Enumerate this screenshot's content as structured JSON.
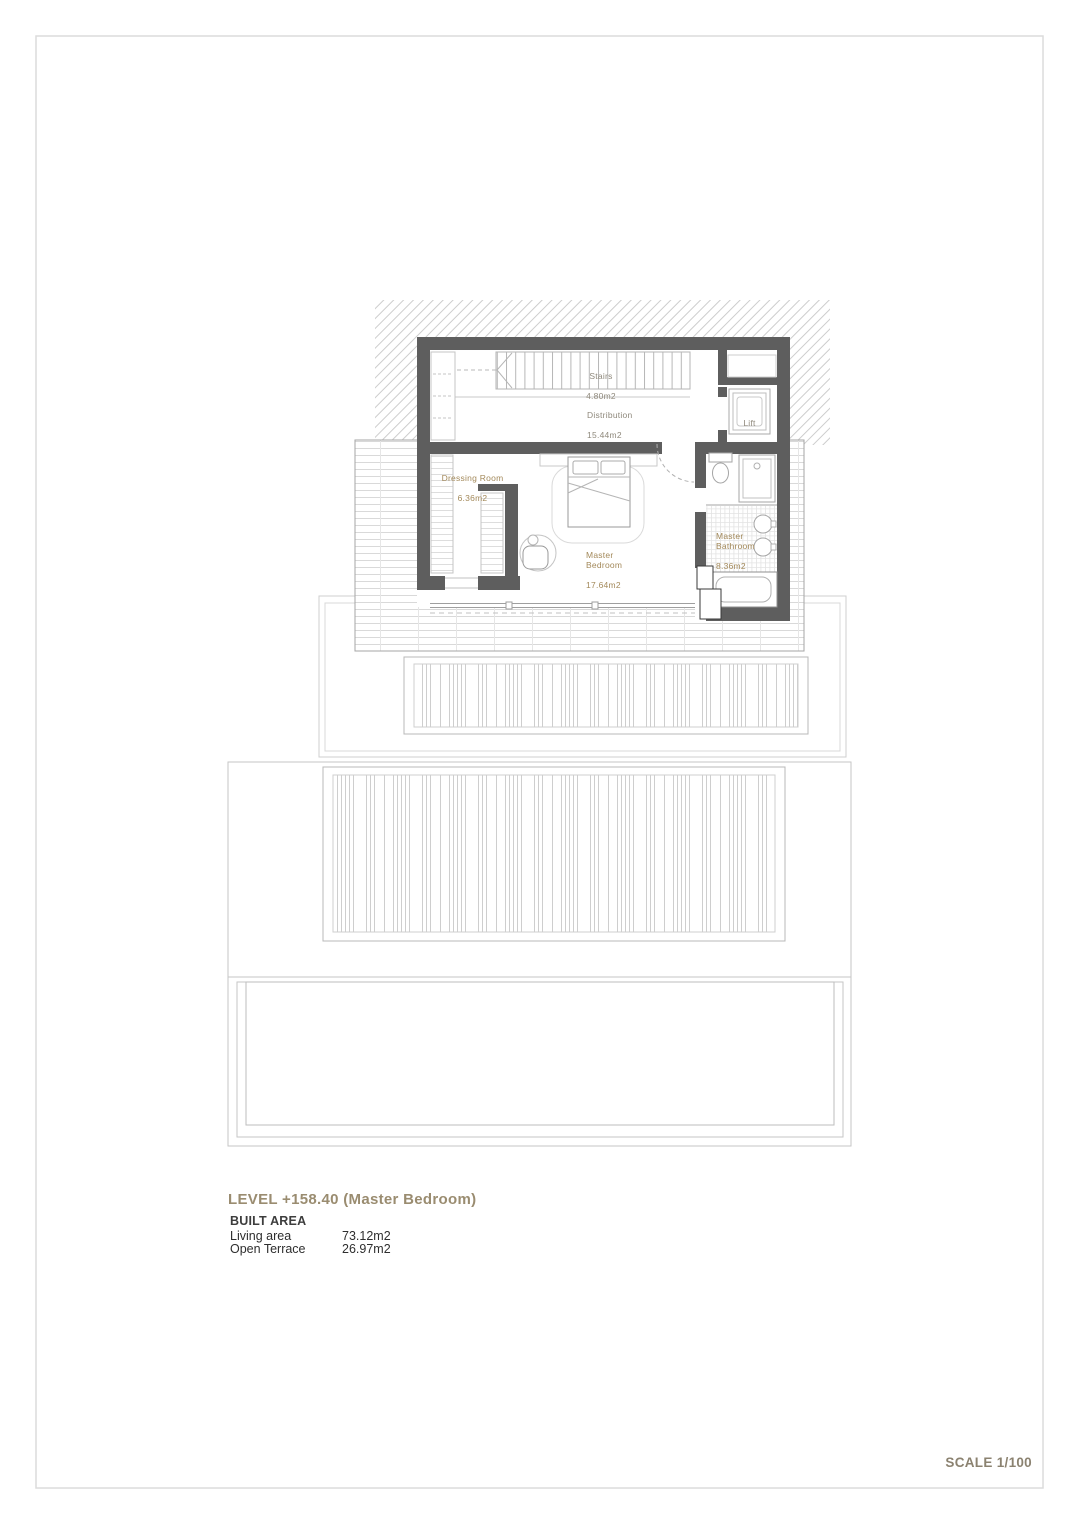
{
  "page": {
    "scale_label": "SCALE 1/100"
  },
  "title_block": {
    "level_title": "LEVEL +158.40 (Master Bedroom)",
    "built_area_heading": "BUILT AREA",
    "areas": [
      {
        "label": "Living area",
        "value": "73.12m2"
      },
      {
        "label": "Open Terrace",
        "value": "26.97m2"
      }
    ]
  },
  "plan": {
    "rooms": [
      {
        "name": "Stairs",
        "area": "4.80m2"
      },
      {
        "name": "Distribution",
        "area": "15.44m2"
      },
      {
        "name": "Lift",
        "area": ""
      },
      {
        "name": "Dressing Room",
        "area": "6.36m2"
      },
      {
        "name": "Master Bedroom",
        "area": "17.64m2"
      },
      {
        "name": "Master Bathroom",
        "area": "8.36m2"
      }
    ]
  },
  "colors": {
    "wall": "#5e5e5e",
    "room_label": "#a3895a",
    "room_label_muted": "#8f897c",
    "title_text": "#9a8c70",
    "body_text": "#2e2e2e",
    "thin_line": "#c6c6c6",
    "sheet_border": "#dcdcdc"
  }
}
